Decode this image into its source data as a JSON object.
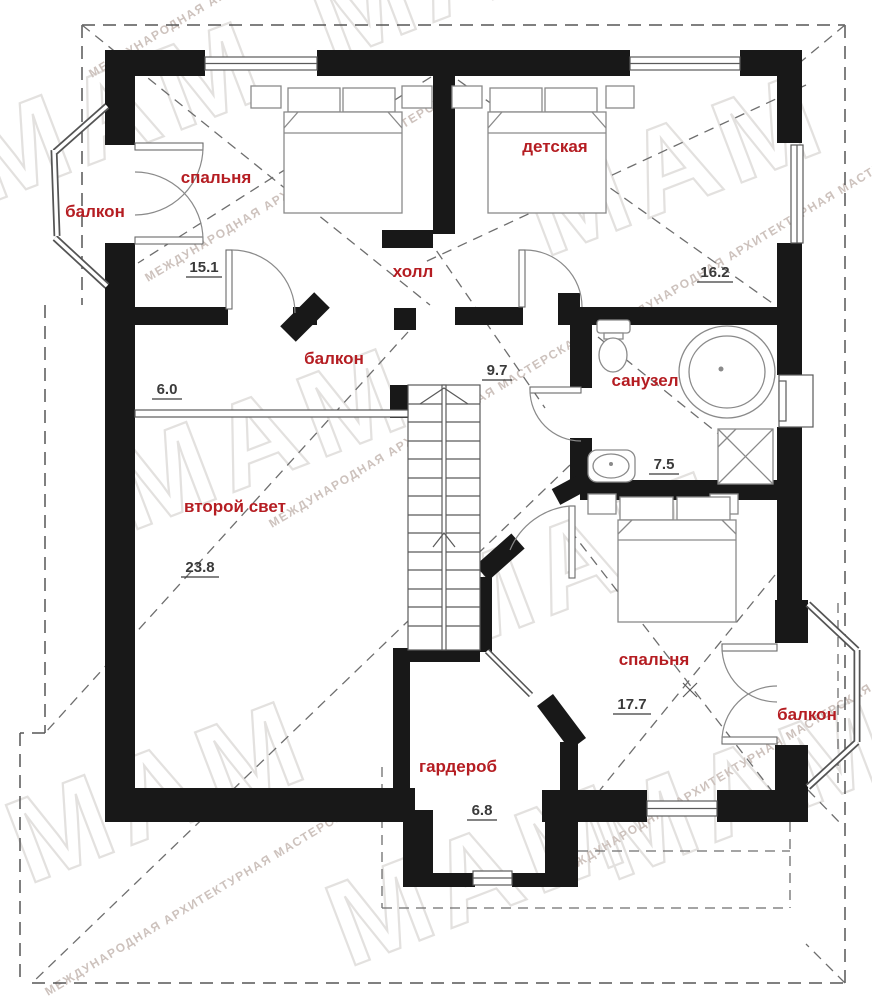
{
  "watermark": {
    "big": "МАМ",
    "small": "МЕЖДУНАРОДНАЯ АРХИТЕКТУРНАЯ МАСТЕРСКАЯ"
  },
  "colors": {
    "wall": "#181818",
    "room_label": "#b51d22",
    "area_number": "#3a3a3a",
    "watermark": "#e3e1df"
  },
  "rooms": [
    {
      "id": "balcony-top-left",
      "label": "балкон"
    },
    {
      "id": "bedroom-1",
      "label": "спальня",
      "area": "15.1"
    },
    {
      "id": "nursery",
      "label": "детская",
      "area": "16.2"
    },
    {
      "id": "hall",
      "label": "холл",
      "area": "9.7"
    },
    {
      "id": "inner-balcony",
      "label": "балкон",
      "area": "6.0"
    },
    {
      "id": "bathroom",
      "label": "санузел",
      "area": "7.5"
    },
    {
      "id": "second-light",
      "label": "второй свет",
      "area": "23.8"
    },
    {
      "id": "bedroom-2",
      "label": "спальня",
      "area": "17.7"
    },
    {
      "id": "balcony-bottom-right",
      "label": "балкон"
    },
    {
      "id": "wardrobe",
      "label": "гардероб",
      "area": "6.8"
    }
  ]
}
